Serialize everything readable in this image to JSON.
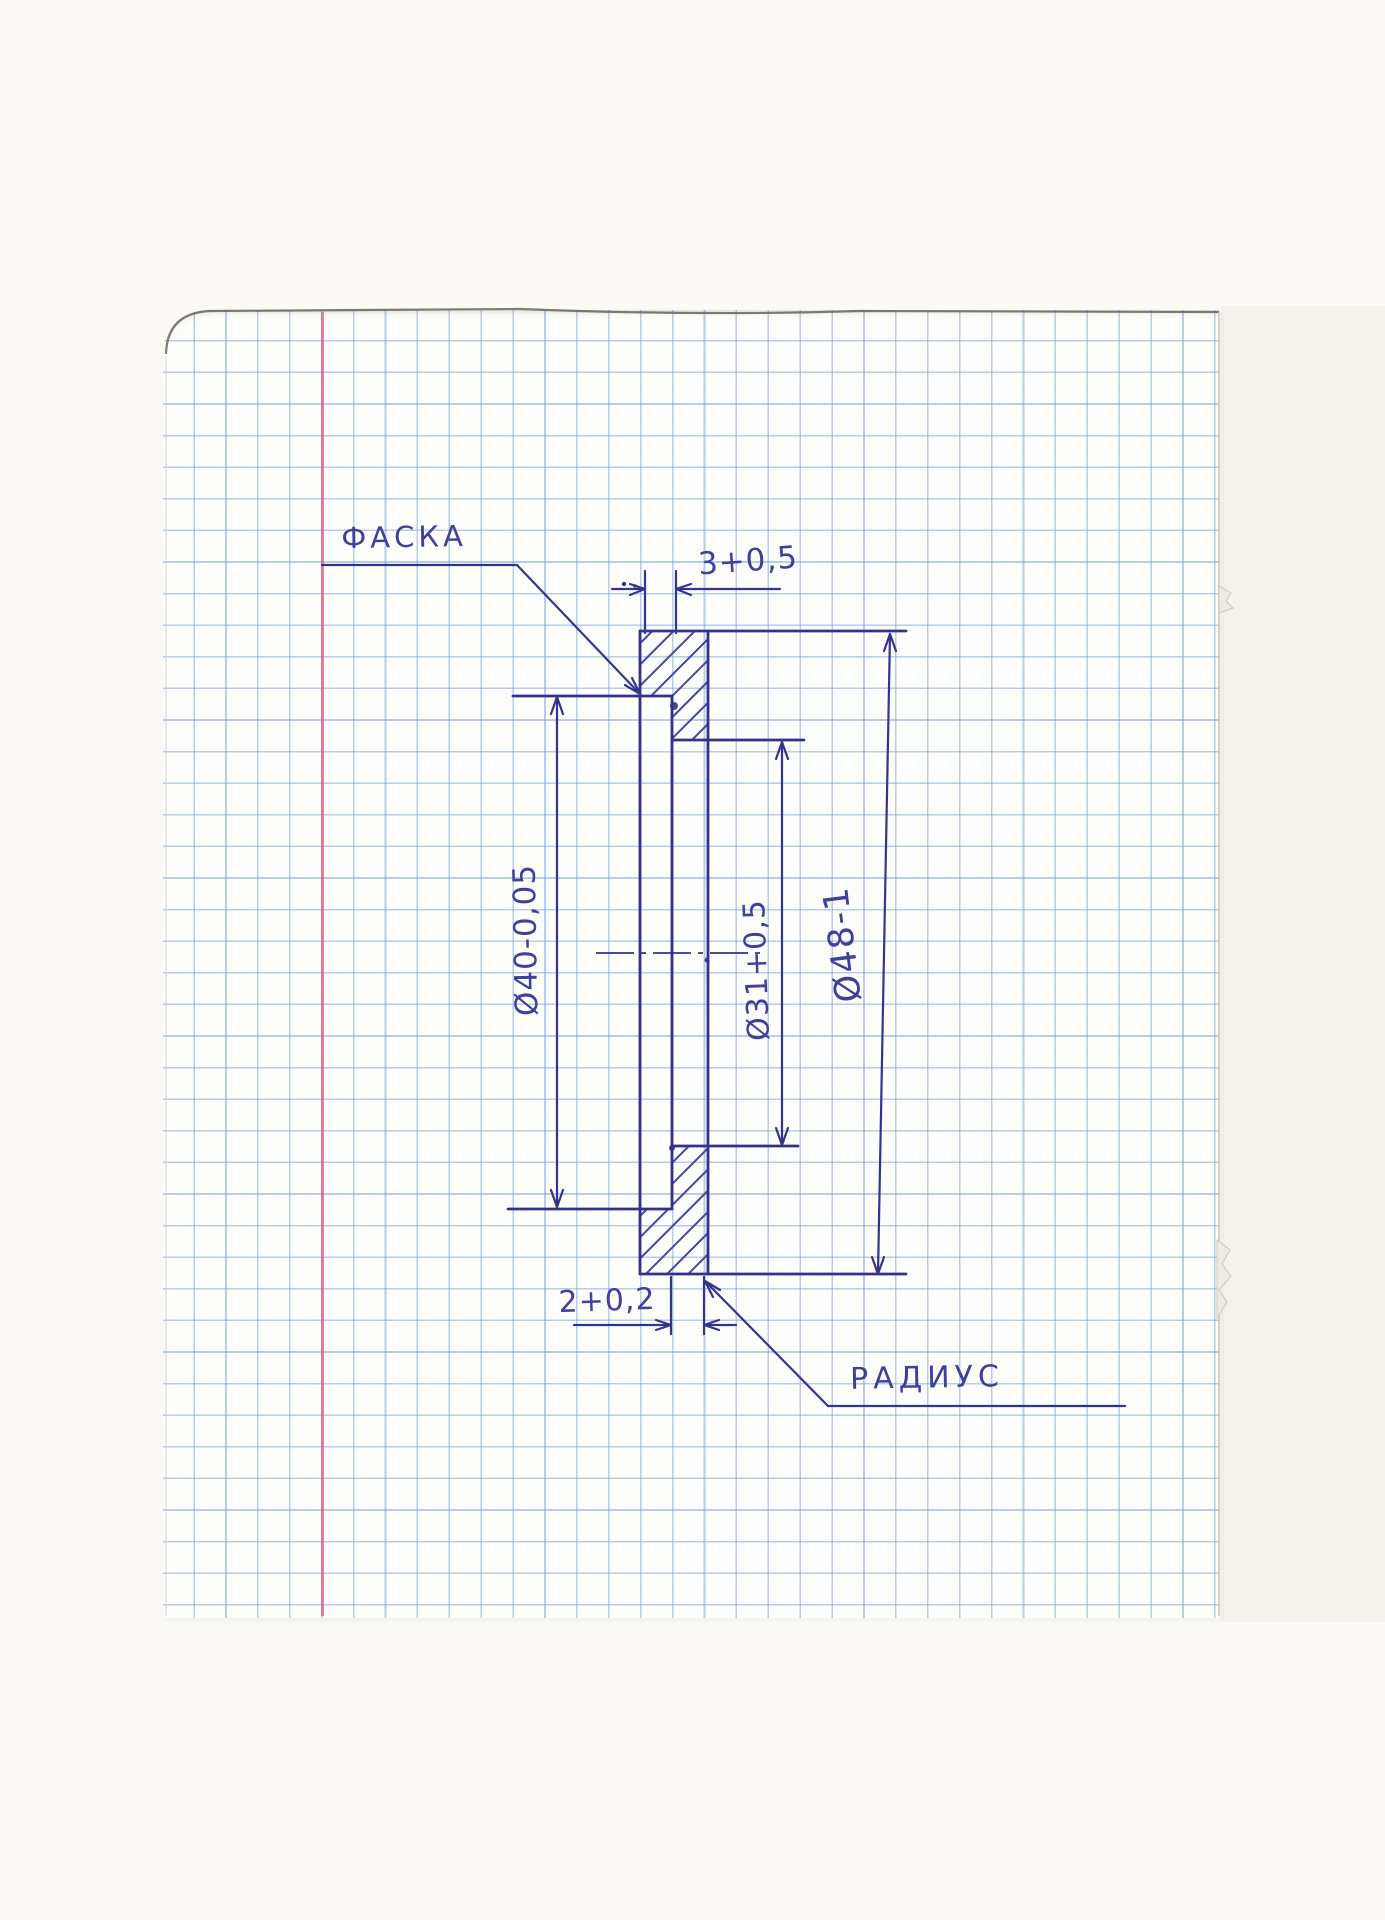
{
  "page": {
    "kind": "scanned squared notebook sheet",
    "grid_square_px": 32,
    "colors": {
      "ink": "#32328c",
      "text_ink": "#3f3f9c",
      "grid_blue": "#769ed4",
      "margin_red": "#de5070",
      "paper": "#fdfdfb",
      "scanner_background": "#f4f2ea"
    }
  },
  "drawing": {
    "labels": {
      "chamfer": "ФАСКА",
      "radius": "РАДИУС"
    },
    "dimensions": {
      "top_width": "3+0,5",
      "recess_diameter": "Ø40-0,05",
      "bore_diameter": "Ø31+0,5",
      "outer_diameter": "Ø48-1",
      "bottom_width": "2+0,2"
    }
  }
}
